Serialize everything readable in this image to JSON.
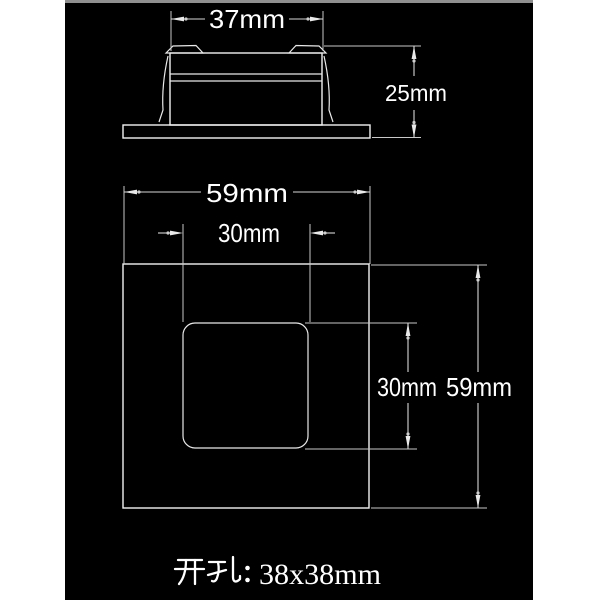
{
  "page": {
    "background_color": "#ffffff",
    "canvas_color": "#000000",
    "line_color": "#d9d9d9",
    "text_color": "#ffffff"
  },
  "side_view": {
    "width_dimension": "37mm",
    "height_dimension": "25mm"
  },
  "front_view": {
    "outer_width_dimension": "59mm",
    "inner_width_dimension": "30mm",
    "inner_height_dimension": "30mm",
    "outer_height_dimension": "59mm"
  },
  "caption": {
    "full_text": "开孔：38x38mm",
    "prefix": "开孔：",
    "cutout_size": "38x38mm"
  }
}
